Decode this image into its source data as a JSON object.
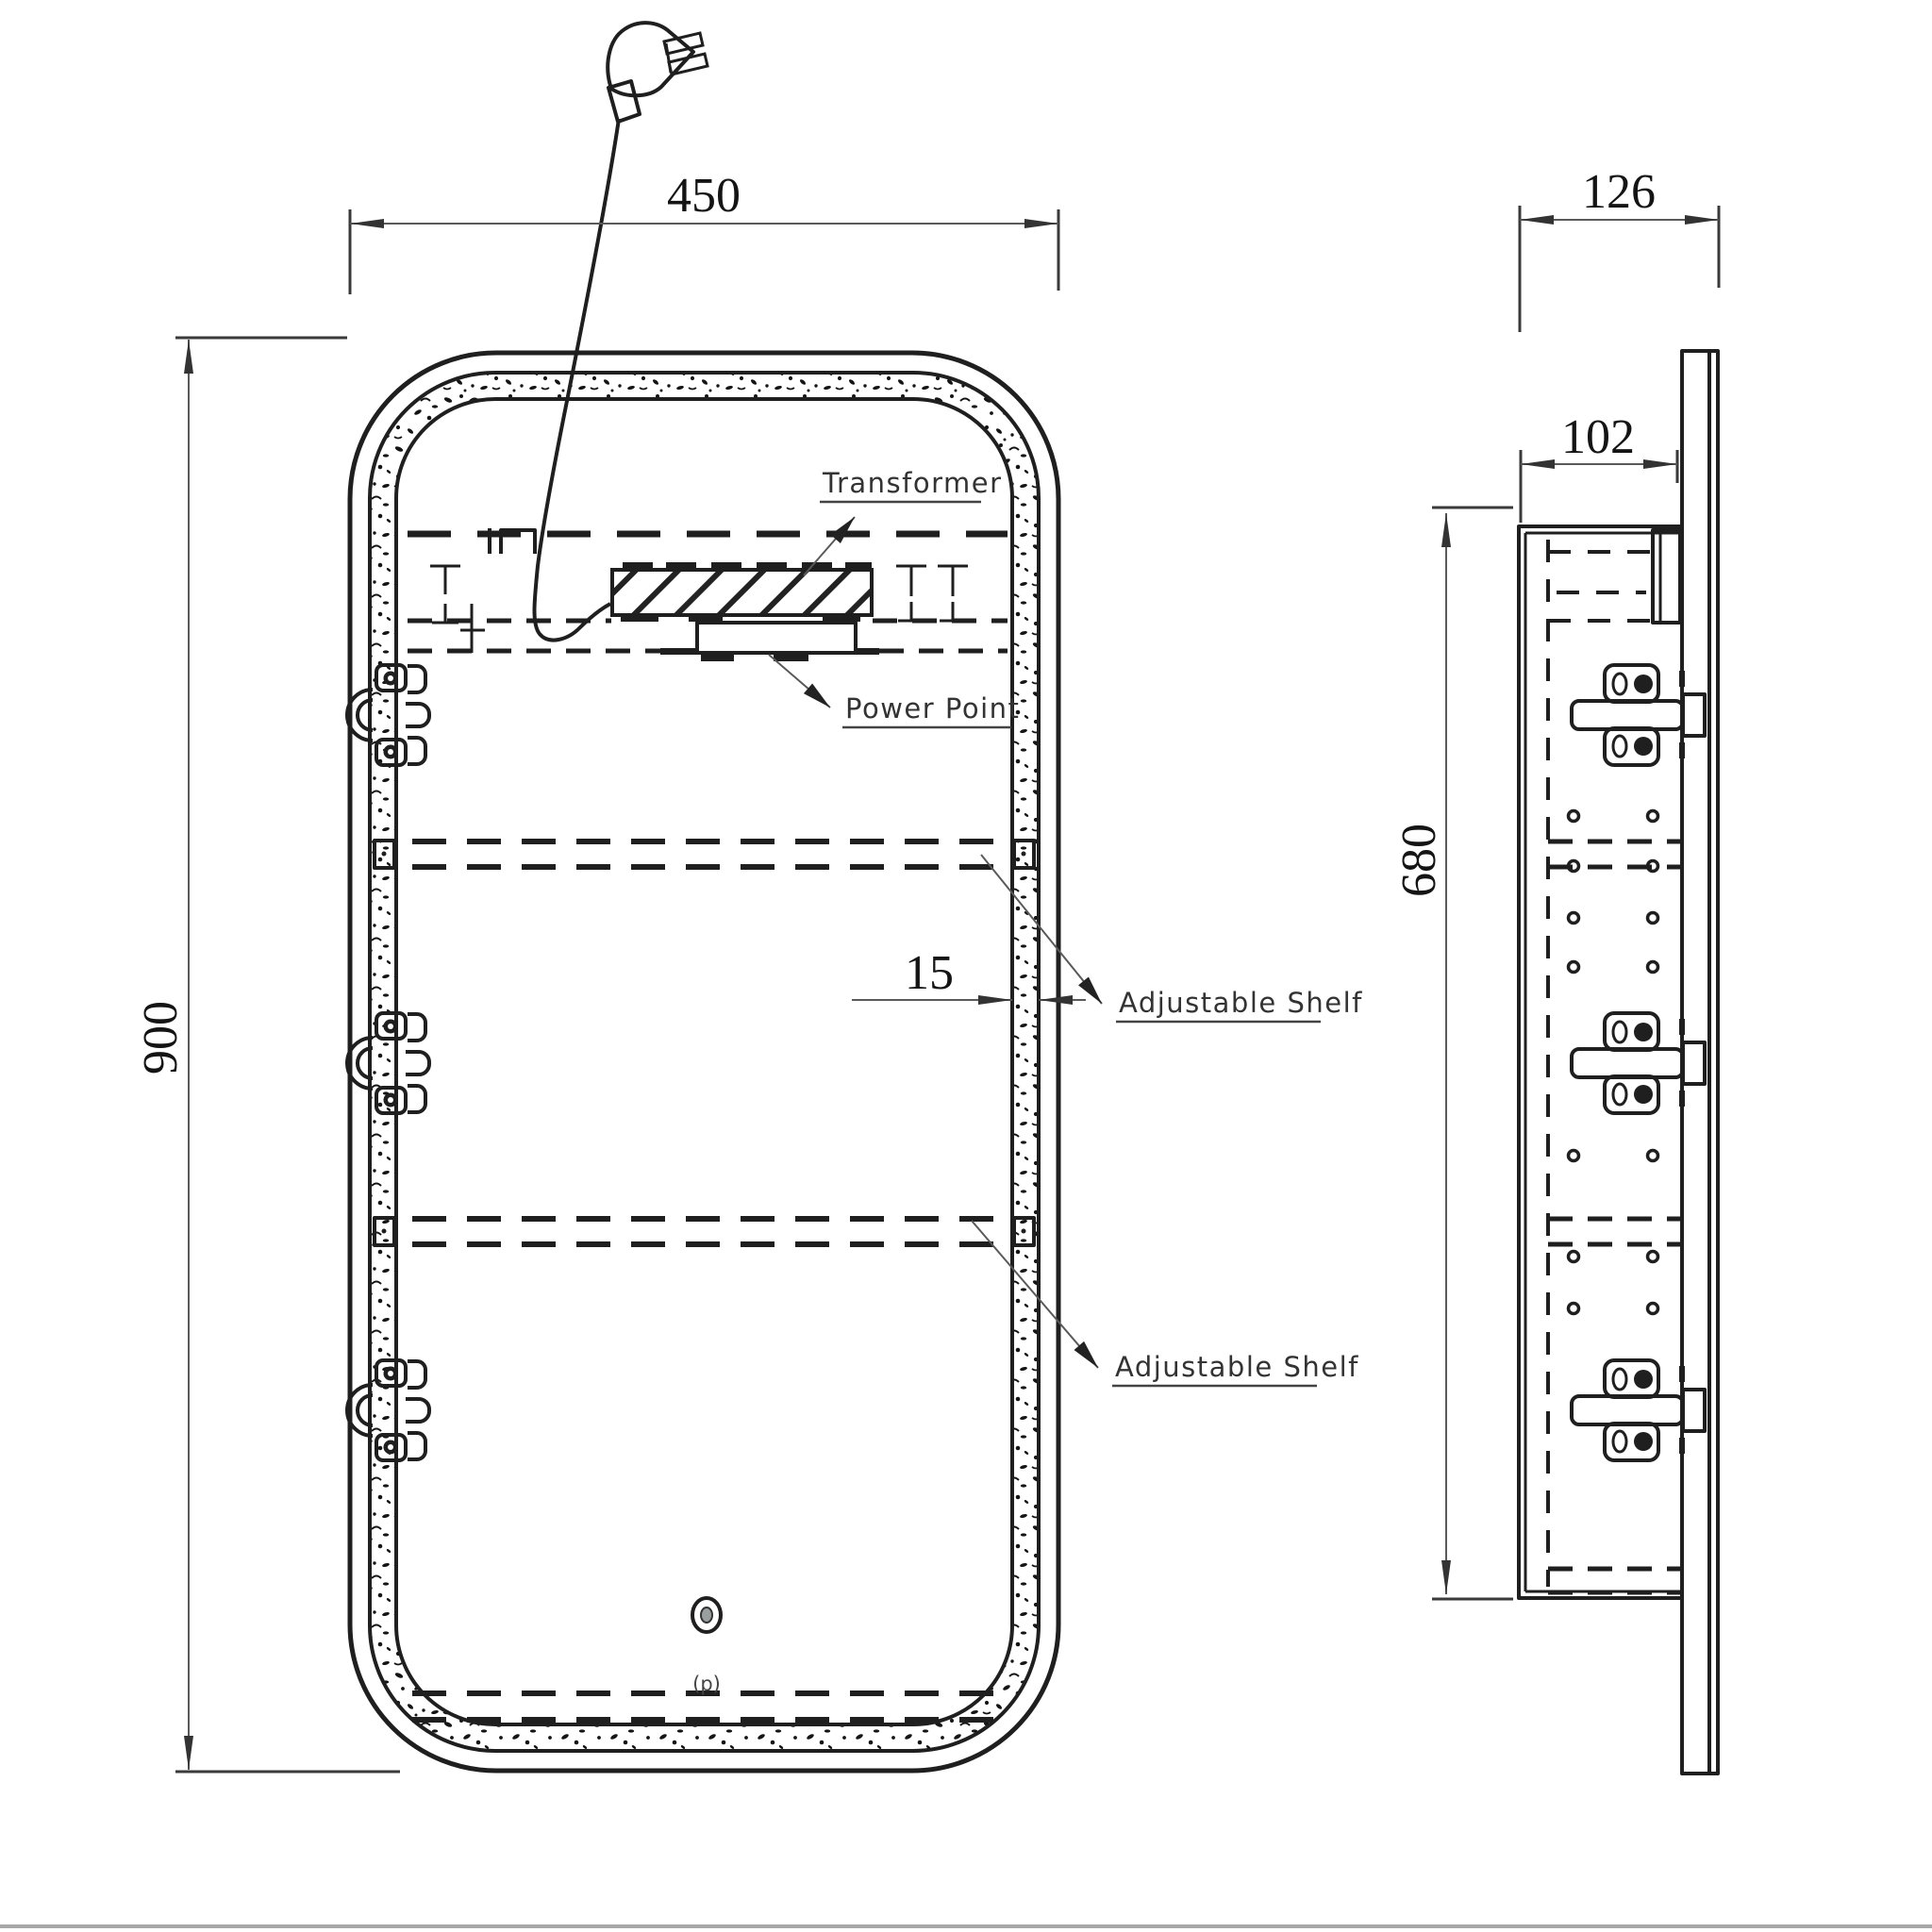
{
  "drawing": {
    "type": "technical-drawing",
    "subject": "mirror cabinet with LED strip, two views (front and side)",
    "colors": {
      "background": "#ffffff",
      "object_line": "#1f1f1f",
      "dimension_line": "#5a5a5a",
      "label_text": "#333333",
      "dimension_text": "#141414"
    },
    "front_view": {
      "dim_width": "450",
      "dim_height": "900",
      "dim_led_strip": "15",
      "labels": {
        "transformer": "Transformer",
        "power_point": "Power Point",
        "adjustable_shelf_top": "Adjustable Shelf",
        "adjustable_shelf_bottom": "Adjustable Shelf",
        "touch_sensor": "(p)"
      },
      "icons": [
        "power-plug-icon",
        "power-cord",
        "transformer-hatched-block",
        "power-point-box",
        "hinge-icon x3",
        "touch-sensor-icon",
        "led-speckle-band"
      ]
    },
    "side_view": {
      "dim_depth_overall": "126",
      "dim_depth_body": "102",
      "dim_height_body": "680",
      "icons": [
        "wall-bracket-icon x3",
        "shelf-pin-holes",
        "back-panel"
      ]
    }
  }
}
